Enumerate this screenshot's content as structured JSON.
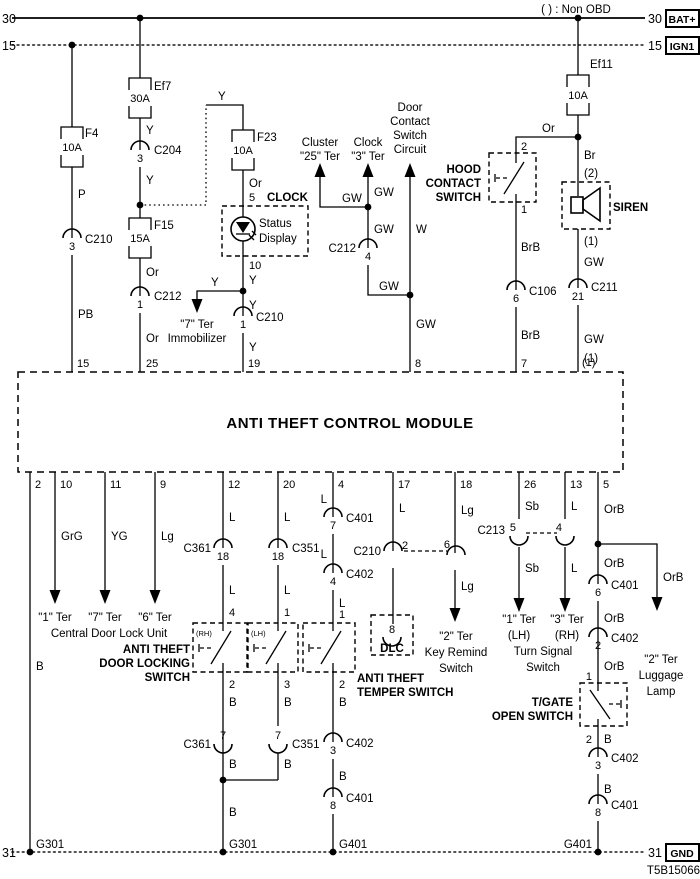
{
  "colors": {
    "ink": "#000000",
    "paper": "#ffffff"
  },
  "legend": {
    "non_obd": "( ) : Non OBD",
    "part_number": "T5B15066"
  },
  "buses": {
    "b30": "30",
    "b15": "15",
    "b31": "31",
    "bat": "BAT+",
    "ign": "IGN1",
    "gnd": "GND"
  },
  "grounds": {
    "g301": "G301",
    "g401": "G401"
  },
  "fuses": {
    "f4": {
      "name": "F4",
      "rating": "10A"
    },
    "ef7": {
      "name": "Ef7",
      "rating": "30A"
    },
    "f23": {
      "name": "F23",
      "rating": "10A"
    },
    "f15": {
      "name": "F15",
      "rating": "15A"
    },
    "ef11": {
      "name": "Ef11",
      "rating": "10A"
    }
  },
  "wires": {
    "p": "P",
    "pb": "PB",
    "y": "Y",
    "or": "Or",
    "gw": "GW",
    "w": "W",
    "br": "Br",
    "brb": "BrB",
    "grg": "GrG",
    "yg": "YG",
    "lg": "Lg",
    "l": "L",
    "b": "B",
    "sb": "Sb",
    "orb": "OrB",
    "np1": "(1)",
    "np2": "(2)"
  },
  "pins": {
    "p1": "1",
    "p2": "2",
    "p3": "3",
    "p4": "4",
    "p5": "5",
    "p6": "6",
    "p7": "7",
    "p8": "8",
    "p10": "10",
    "p18": "18",
    "p21": "21"
  },
  "connectors": {
    "c204": "C204",
    "c210": "C210",
    "c212": "C212",
    "c106": "C106",
    "c211": "C211",
    "c213": "C213",
    "c361": "C361",
    "c351": "C351",
    "c401": "C401",
    "c402": "C402"
  },
  "module": {
    "title": "ANTI THEFT CONTROL MODULE",
    "top": {
      "t15": "15",
      "t25": "25",
      "t19": "19",
      "t8": "8",
      "t7": "7",
      "t1": "(1)"
    },
    "bottom": {
      "t2": "2",
      "t10": "10",
      "t11": "11",
      "t9": "9",
      "t12": "12",
      "t20": "20",
      "t4": "4",
      "t17": "17",
      "t18": "18",
      "t26": "26",
      "t13": "13",
      "t5": "5"
    }
  },
  "components": {
    "clock": {
      "name": "CLOCK",
      "display_l1": "Status",
      "display_l2": "Display"
    },
    "cluster": {
      "l1": "Cluster",
      "l2": "\"25\" Ter"
    },
    "clock_target": {
      "l1": "Clock",
      "l2": "\"3\" Ter"
    },
    "door_circuit": {
      "l1": "Door",
      "l2": "Contact",
      "l3": "Switch",
      "l4": "Circuit"
    },
    "immobilizer": {
      "l1": "\"7\" Ter",
      "l2": "Immobilizer"
    },
    "hood": {
      "l1": "HOOD",
      "l2": "CONTACT",
      "l3": "SWITCH"
    },
    "siren": {
      "name": "SIREN"
    },
    "cdlu": {
      "t1": "\"1\" Ter",
      "t7": "\"7\" Ter",
      "t6": "\"6\" Ter",
      "name": "Central Door Lock Unit"
    },
    "door_locking": {
      "l1": "ANTI THEFT",
      "l2": "DOOR LOCKING",
      "l3": "SWITCH",
      "rh": "(RH)",
      "lh": "(LH)"
    },
    "temper": {
      "l1": "ANTI THEFT",
      "l2": "TEMPER SWITCH"
    },
    "dlc": {
      "name": "DLC"
    },
    "key_remind": {
      "l1": "\"2\" Ter",
      "l2": "Key Remind",
      "l3": "Switch"
    },
    "turn_signal": {
      "lh_ter": "\"1\" Ter",
      "lh": "(LH)",
      "rh_ter": "\"3\" Ter",
      "rh": "(RH)",
      "l1": "Turn Signal",
      "l2": "Switch"
    },
    "luggage": {
      "l1": "\"2\" Ter",
      "l2": "Luggage",
      "l3": "Lamp"
    },
    "tgate": {
      "l1": "T/GATE",
      "l2": "OPEN SWITCH"
    }
  }
}
